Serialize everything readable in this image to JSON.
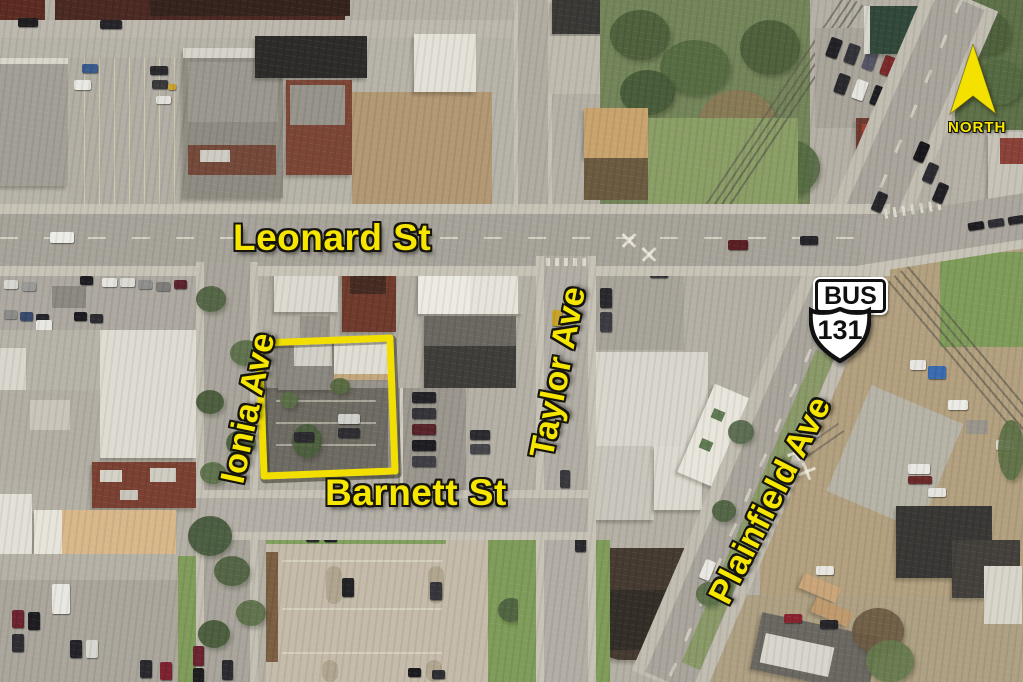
{
  "map": {
    "street_labels": {
      "leonard": "Leonard St",
      "ionia": "Ionia Ave",
      "taylor": "Taylor Ave",
      "barnett": "Barnett St",
      "plainfield": "Plainfield Ave"
    },
    "route_shield": {
      "banner": "BUS",
      "number": "131"
    },
    "compass": {
      "label": "NORTH",
      "arrow_icon": "north-arrow"
    },
    "highlight": {
      "shape": "property-outline-rectangle"
    },
    "colors": {
      "label_yellow": "#F7E600",
      "label_outline": "#15150E",
      "highlight_yellow": "#F2DF00",
      "shield_fill": "#FFFFFF",
      "shield_ink": "#111111"
    }
  }
}
